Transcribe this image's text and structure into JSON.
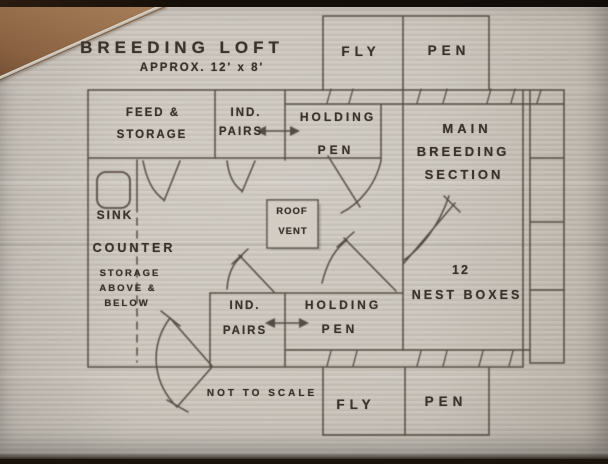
{
  "drawing": {
    "title": "BREEDING LOFT",
    "subtitle": "APPROX. 12' x 8'",
    "scale_note": "NOT TO SCALE"
  },
  "rooms": {
    "fly_pen_top": {
      "fly": "FLY",
      "pen": "PEN"
    },
    "feed_storage": {
      "line1": "FEED &",
      "line2": "STORAGE"
    },
    "ind_pairs_top": {
      "line1": "IND.",
      "line2": "PAIRS"
    },
    "holding_pen_top": {
      "line1": "HOLDING",
      "line2": "PEN"
    },
    "main_breeding_section": {
      "line1": "MAIN",
      "line2": "BREEDING",
      "line3": "SECTION"
    },
    "nest_boxes": {
      "line1": "12",
      "line2": "NEST BOXES"
    },
    "ind_pairs_bottom": {
      "line1": "IND.",
      "line2": "PAIRS"
    },
    "holding_pen_bottom": {
      "line1": "HOLDING",
      "line2": "PEN"
    },
    "fly_pen_bottom": {
      "fly": "FLY",
      "pen": "PEN"
    }
  },
  "fixtures": {
    "sink": "SINK",
    "counter": "COUNTER",
    "roof_vent": {
      "line1": "ROOF",
      "line2": "VENT"
    },
    "storage_note": {
      "line1": "STORAGE",
      "line2": "ABOVE &",
      "line3": "BELOW"
    }
  },
  "colors": {
    "ink": "#4c423a",
    "paper": "#c9c3ba",
    "table_wood": "#9c744e",
    "frame": "#17100b"
  }
}
